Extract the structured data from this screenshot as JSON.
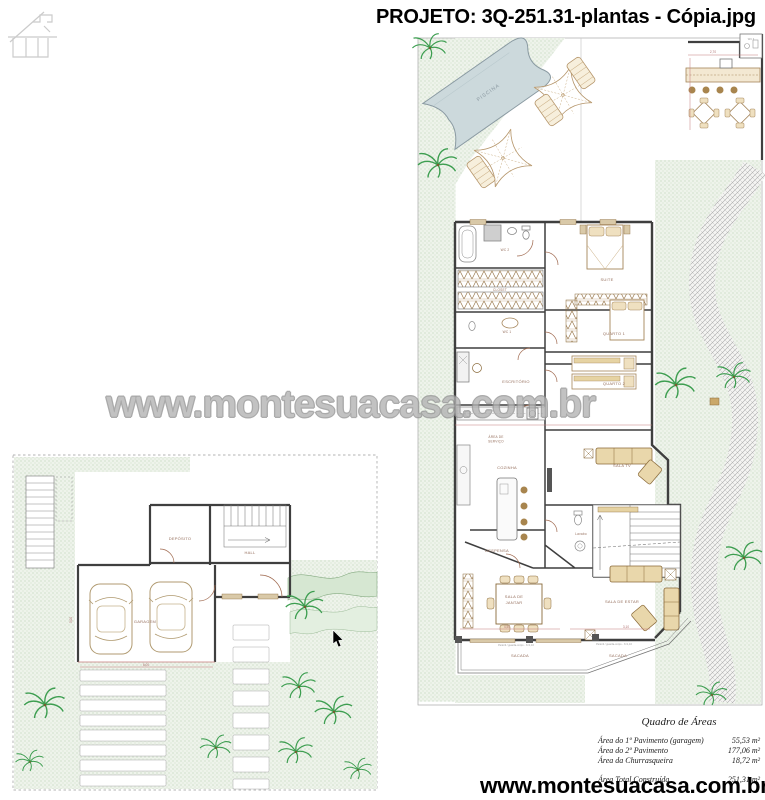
{
  "header": {
    "title": "PROJETO: 3Q-251.31-plantas - Cópia.jpg"
  },
  "watermark": "www.montesuacasa.com.br",
  "footer_url": "www.montesuacasa.com.br",
  "areas_table": {
    "title": "Quadro de Áreas",
    "rows": [
      {
        "label": "Área do 1º Pavimento (garagem)",
        "value": "55,53 m²"
      },
      {
        "label": "Área do 2º Pavimento",
        "value": "177,06 m²"
      },
      {
        "label": "Área da Churrasqueira",
        "value": "18,72 m²"
      }
    ],
    "total": {
      "label": "Área Total Construída",
      "value": "251,31 m²"
    }
  },
  "upper_plan": {
    "piscina": "PISCINA",
    "wc3": "WC 3",
    "wc2": "WC 2",
    "closet": "CLOSET",
    "suite": "SUITE",
    "wc1": "WC 1",
    "quarto1": "QUARTO 1",
    "escritorio": "ESCRITÓRIO",
    "quarto2": "QUARTO 2",
    "area_servico_l1": "ÁREA DE",
    "area_servico_l2": "SERVIÇO",
    "cozinha": "COZINHA",
    "sala_tv": "SALA TV",
    "despensa": "DESPENSA",
    "lavabo": "Lavabo",
    "sala_jantar_l1": "SALA DE",
    "sala_jantar_l2": "JANTAR",
    "sala_estar": "SALA DE ESTAR",
    "sacada_1": "SACADA",
    "sacada_2": "SACADA",
    "dim_top": "2,70",
    "dim_jantar": "4,50",
    "dim_estar": "3,10",
    "rail_note_1": "Peitoril / guarda-corpo - h=1,10",
    "rail_note_2": "Peitoril / guarda-corpo - h=1,10"
  },
  "lower_plan": {
    "deposito": "DEPÓSITO",
    "hall": "HALL",
    "garagem": "GARAGEM",
    "dim_garage_w": "6,00",
    "dim_garage_h": "3,00"
  },
  "colors": {
    "lawn_dot": "#a9c5a4",
    "wall": "#3f3f3f",
    "furniture": "#8a6a3a",
    "label": "#96705e",
    "dimension": "#b07070",
    "door_accent": "#a06a50",
    "pool_fill": "#ccd9dc",
    "palm": "#3d9e50"
  }
}
